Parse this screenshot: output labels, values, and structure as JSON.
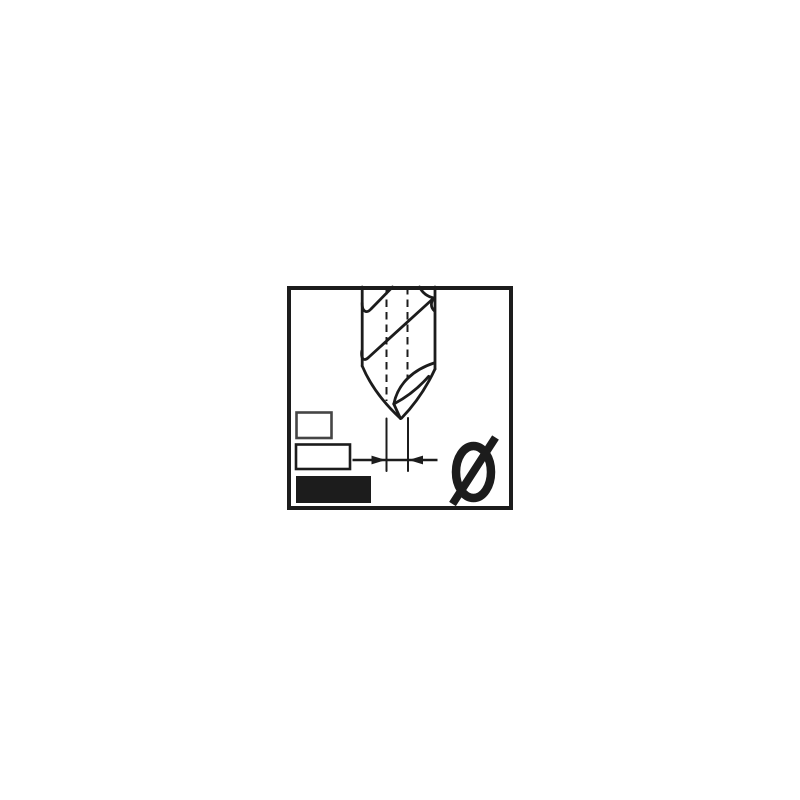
{
  "diagram": {
    "type": "technical-icon",
    "subject": "Twist drill bit with point diameter dimension",
    "diameter_symbol": "Ø",
    "icons": [
      {
        "name": "drill-bit-icon",
        "depicts": "twist drill bit, side view, point down"
      },
      {
        "name": "diameter-symbol-icon",
        "glyph": "Ø"
      },
      {
        "name": "dimension-arrows-icon",
        "depicts": "opposing arrows measuring the drill point width"
      }
    ],
    "swatches": [
      {
        "name": "swatch-small-outline",
        "style": "outlined"
      },
      {
        "name": "swatch-medium-outline",
        "style": "outlined"
      },
      {
        "name": "swatch-large-filled",
        "style": "filled"
      }
    ],
    "colors": {
      "ink": "#1c1c1c",
      "background": "#ffffff",
      "swatch_small_border": "#454545"
    }
  }
}
